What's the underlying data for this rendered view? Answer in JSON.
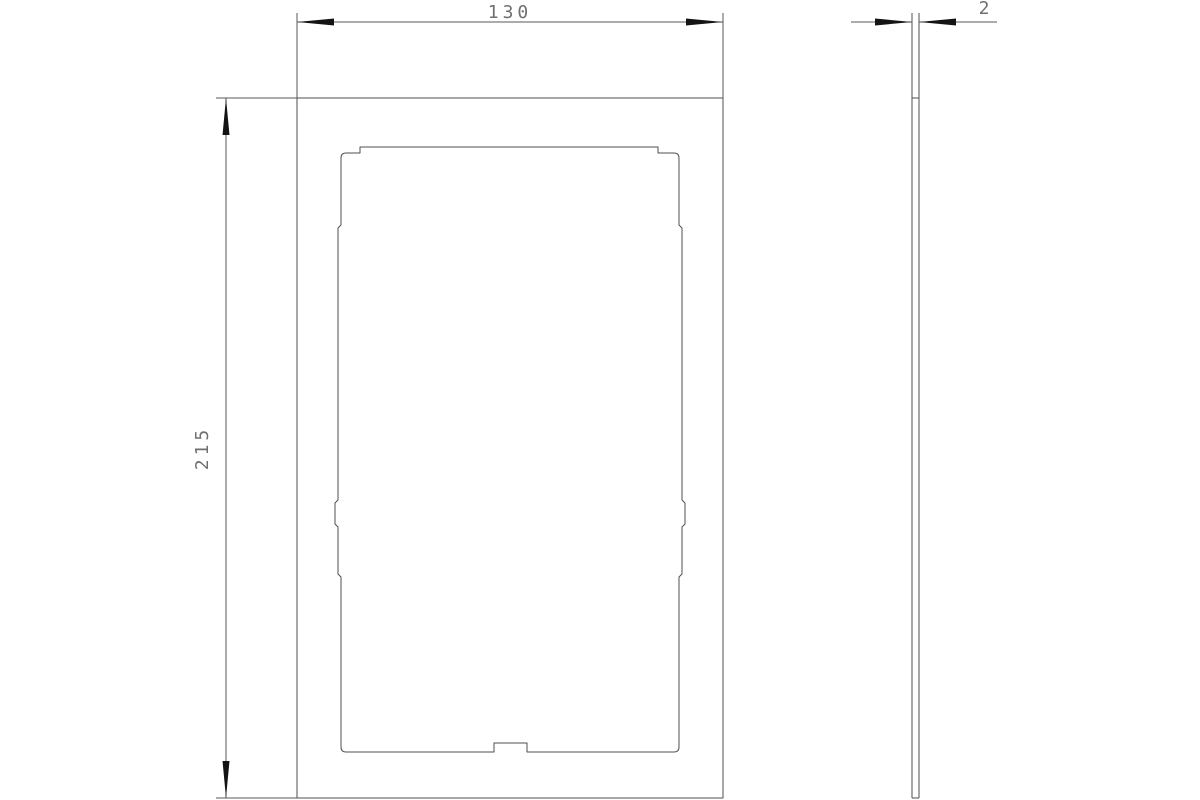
{
  "canvas": {
    "width": 1200,
    "height": 800
  },
  "colors": {
    "background": "#ffffff",
    "outline": "#4f4f4f",
    "dimension": "#5a5a5a",
    "arrow": "#141414",
    "text": "#707070"
  },
  "drawing": {
    "type": "technical-dimension-drawing",
    "views": {
      "front": {
        "outer_outline_d": "M 297 98 H 723 V 798 H 297 Z",
        "cutout_outline_d": "M 360 147 H 658 V 153 H 674 Q 679 153 679 158 V 225 L 682 228 V 500 L 685 503 V 524 L 682 527 V 574 L 679 577 V 747 Q 679 752 674 752 H 527 V 743 H 494 V 752 H 346 Q 341 752 341 747 V 577 L 338 574 V 527 L 335 524 V 503 L 338 500 V 228 L 341 225 V 158 Q 341 153 346 153 H 360 Z"
      },
      "side": {
        "outline_d": "M 912 13 V 798 M 919 13 V 798 M 912 98 H 919 M 912 798 H 919"
      }
    },
    "dimensions": {
      "width": {
        "label": "130",
        "lines_d": "M 297 13 V 98 M 723 13 V 98 M 297 22 H 723",
        "arrow_start_points": "297,22 334,18.5 334,25.5",
        "arrow_end_points": "723,22 686,18.5 686,25.5",
        "label_transform": "translate(510 18)"
      },
      "height": {
        "label": "215",
        "lines_d": "M 216 98 H 297 M 216 798 H 297 M 226 98 V 798",
        "arrow_start_points": "226,98 222.5,135 229.5,135",
        "arrow_end_points": "226,798 222.5,761 229.5,761",
        "label_transform": "translate(208 448) rotate(-90)"
      },
      "thickness": {
        "label": "2",
        "lines_d": "M 851 22 H 912 M 919 22 H 997",
        "arrow_start_points": "912,22 875,18.5 875,25.5",
        "arrow_end_points": "919,22 956,18.5 956,25.5",
        "label_transform": "translate(986 14)"
      }
    }
  }
}
